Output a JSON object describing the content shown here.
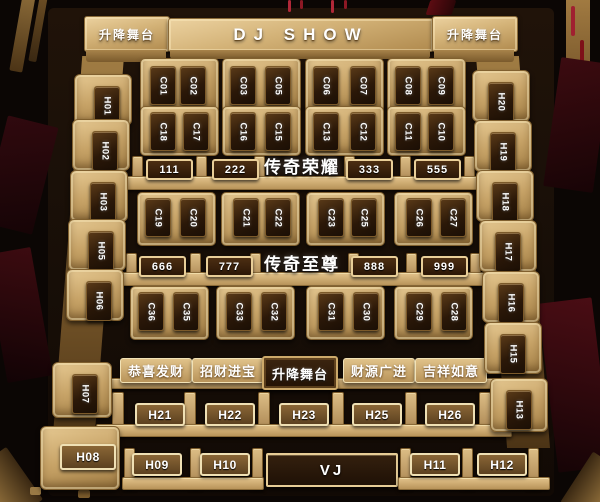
{
  "stage": {
    "dj_label": "DJ SHOW",
    "lift_label_left": "升降舞台",
    "lift_label_right": "升降舞台"
  },
  "sections": {
    "row_a_name": "传奇荣耀",
    "row_b_name": "传奇至尊",
    "center_platform_label": "升降舞台",
    "plates": [
      "恭喜发财",
      "招财进宝",
      "财源广进",
      "吉祥如意"
    ]
  },
  "c_rows": [
    [
      "C01",
      "C02",
      "C03",
      "C05",
      "C06",
      "C07",
      "C08",
      "C09"
    ],
    [
      "C18",
      "C17",
      "C16",
      "C15",
      "C13",
      "C12",
      "C11",
      "C10"
    ],
    [
      "C19",
      "C20",
      "C21",
      "C22",
      "C23",
      "C25",
      "C26",
      "C27"
    ],
    [
      "C36",
      "C35",
      "C33",
      "C32",
      "C31",
      "C30",
      "C29",
      "C28"
    ]
  ],
  "sofa_badges": [
    [
      "111",
      "222",
      "333",
      "555"
    ],
    [
      "666",
      "777",
      "888",
      "999"
    ]
  ],
  "left_column": [
    "H01",
    "H02",
    "H03",
    "H05",
    "H06",
    "H07"
  ],
  "right_column": [
    "H20",
    "H19",
    "H18",
    "H17",
    "H16",
    "H15",
    "H13"
  ],
  "h_bench": [
    "H21",
    "H22",
    "H23",
    "H25",
    "H26"
  ],
  "bottom_row": {
    "corner": "H08",
    "left_bench": [
      "H09",
      "H10"
    ],
    "vj_label": "VJ",
    "right_bench": [
      "H11",
      "H12"
    ]
  },
  "colors": {
    "gold": "#c9a264",
    "gold_light": "#ecd6a2",
    "dark_table": "#2a1808",
    "floor": "#170e07",
    "red_accent": "#7e1018",
    "label_text": "#ffffff"
  }
}
